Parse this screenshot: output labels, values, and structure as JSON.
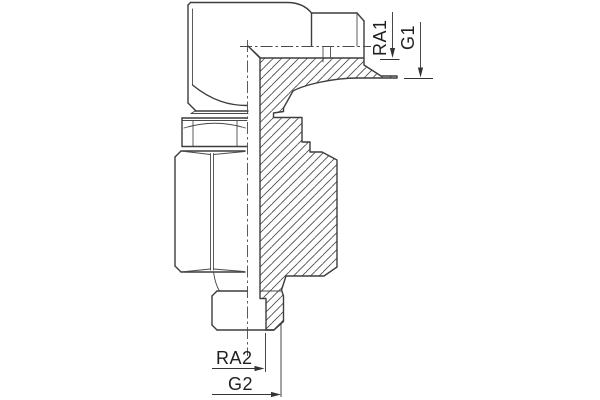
{
  "drawing": {
    "kind": "technical-section-drawing",
    "labels": {
      "ra1": "RA1",
      "g1": "G1",
      "ra2": "RA2",
      "g2": "G2"
    },
    "colors": {
      "background": "#ffffff",
      "line": "#3d3d3d",
      "hatch": "#4a4a4a",
      "dimension": "#333333",
      "text": "#1f1f1f"
    }
  }
}
